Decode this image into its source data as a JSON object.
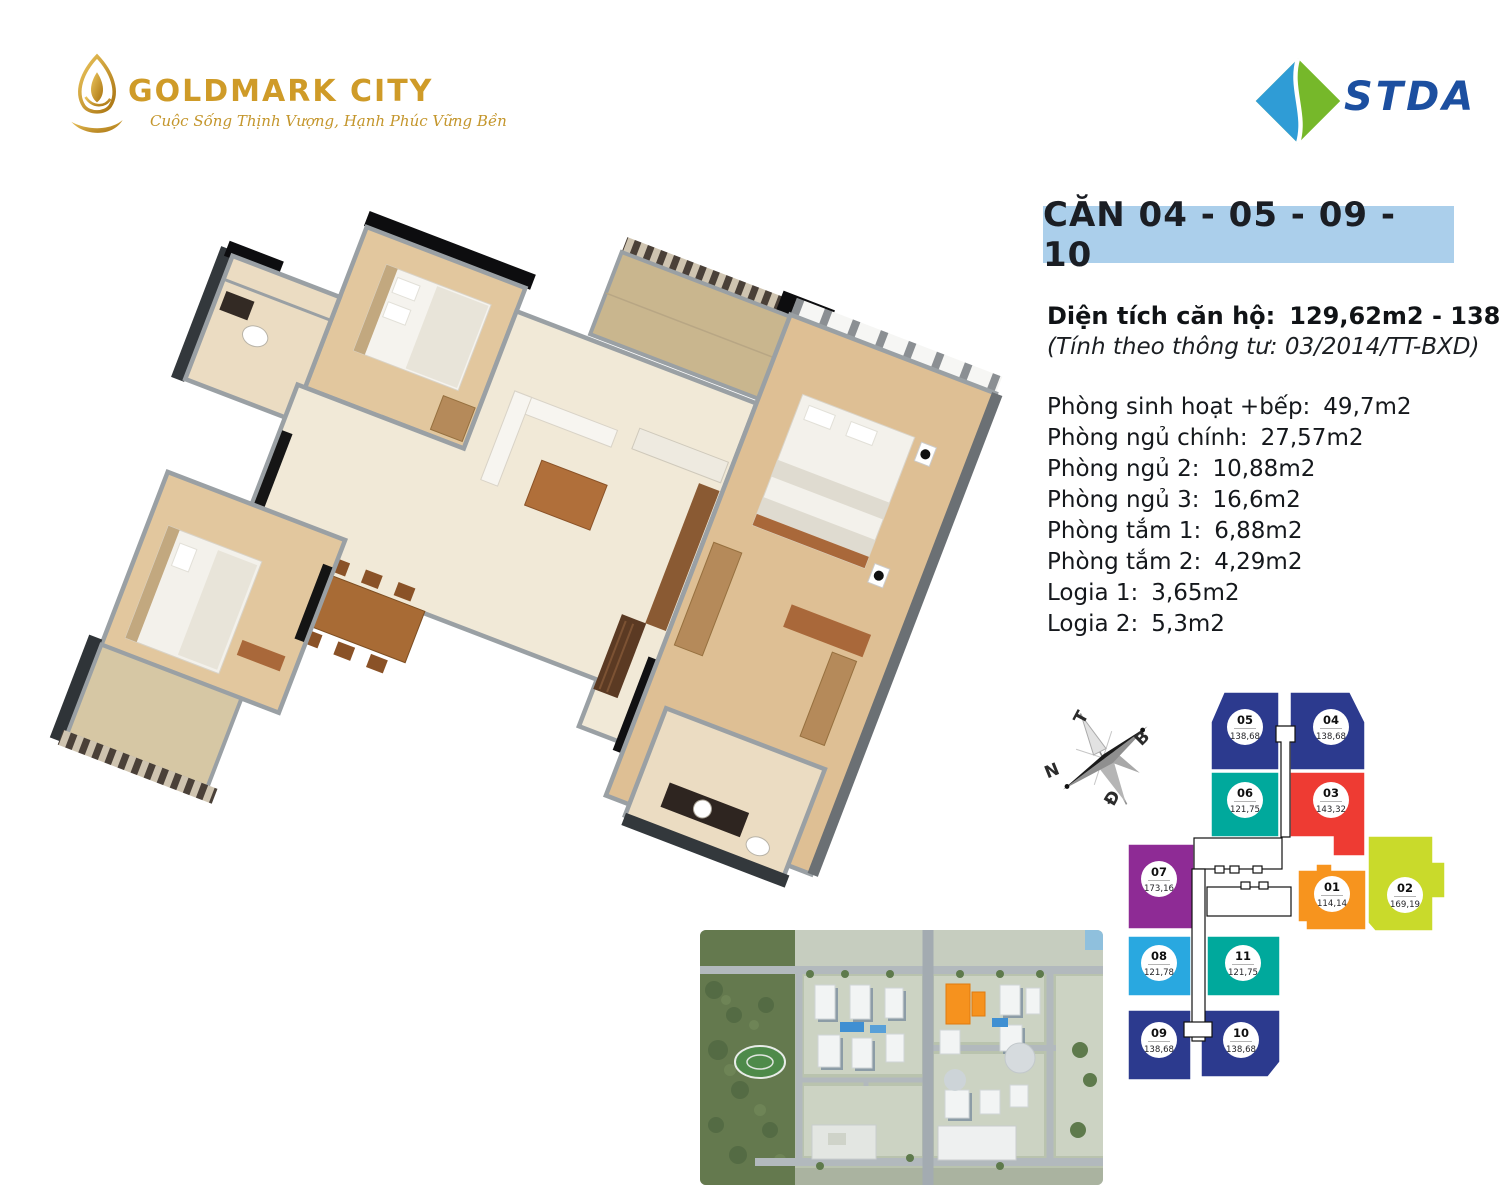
{
  "brand": {
    "name": "GOLDMARK CITY",
    "tagline": "Cuộc Sống Thịnh Vượng, Hạnh Phúc Vững Bền",
    "gold": "#cf9b28"
  },
  "partner": {
    "name": "STDA",
    "blue": "#2f9cd6",
    "green": "#76b82a",
    "text_color": "#1c4fa0"
  },
  "unit_header": {
    "title": "CĂN 04 - 05 - 09 - 10",
    "bg": "#abcfeb"
  },
  "area": {
    "label": "Diện tích căn hộ:",
    "value": "129,62m2 - 138,68m2",
    "note": "(Tính theo thông tư: 03/2014/TT-BXD)"
  },
  "rooms": [
    {
      "label": "Phòng sinh hoạt +bếp:",
      "value": "49,7m2"
    },
    {
      "label": "Phòng ngủ chính:",
      "value": "27,57m2"
    },
    {
      "label": "Phòng ngủ 2:",
      "value": "10,88m2"
    },
    {
      "label": "Phòng ngủ 3:",
      "value": "16,6m2"
    },
    {
      "label": "Phòng tắm 1:",
      "value": "6,88m2"
    },
    {
      "label": "Phòng tắm 2:",
      "value": "4,29m2"
    },
    {
      "label": "Logia 1:",
      "value": "3,65m2"
    },
    {
      "label": "Logia 2:",
      "value": "5,3m2"
    }
  ],
  "compass": {
    "west": "T",
    "north": "B",
    "south": "N",
    "east": "Đ"
  },
  "floorplate": {
    "units": [
      {
        "id": "05",
        "area": "138,68",
        "color": "#2c3a8e"
      },
      {
        "id": "04",
        "area": "138,68",
        "color": "#2c3a8e"
      },
      {
        "id": "06",
        "area": "121,75",
        "color": "#00a99c"
      },
      {
        "id": "03",
        "area": "143,32",
        "color": "#ee3b33"
      },
      {
        "id": "07",
        "area": "173,16",
        "color": "#8e2b95"
      },
      {
        "id": "01",
        "area": "114,14",
        "color": "#f7941e"
      },
      {
        "id": "02",
        "area": "169,19",
        "color": "#c9da2b"
      },
      {
        "id": "08",
        "area": "121,78",
        "color": "#29a8e0"
      },
      {
        "id": "11",
        "area": "121,75",
        "color": "#00a99c"
      },
      {
        "id": "09",
        "area": "138,68",
        "color": "#2c3a8e"
      },
      {
        "id": "10",
        "area": "138,68",
        "color": "#2c3a8e"
      }
    ]
  }
}
